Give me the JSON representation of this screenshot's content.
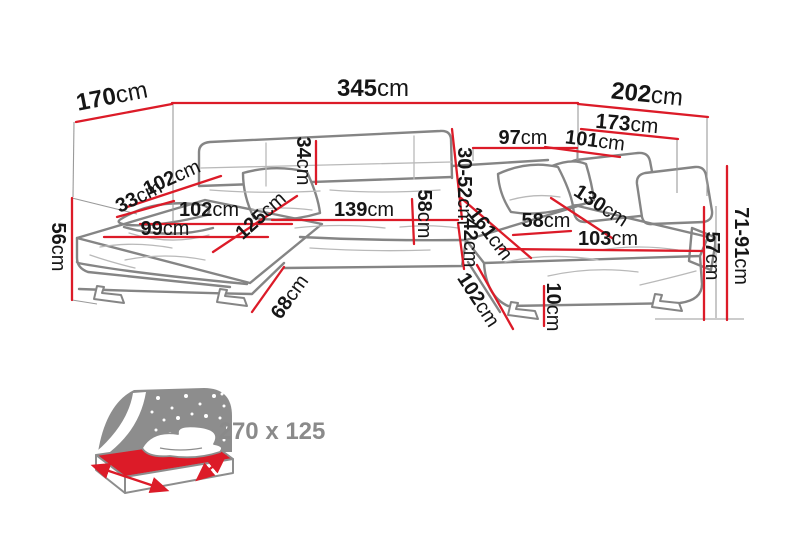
{
  "diagram": {
    "subject": "u-shaped-corner-sofa-dimensions",
    "unit_default": "cm"
  },
  "dimensions": [
    {
      "name": "back-width-left",
      "value": "170",
      "unit": "cm"
    },
    {
      "name": "total-width",
      "value": "345",
      "unit": "cm"
    },
    {
      "name": "back-width-right",
      "value": "202",
      "unit": "cm"
    },
    {
      "name": "right-side-length",
      "value": "173",
      "unit": "cm"
    },
    {
      "name": "right-back-section",
      "value": "97",
      "unit": "cm"
    },
    {
      "name": "right-inner-length",
      "value": "101",
      "unit": "cm"
    },
    {
      "name": "headrest-height",
      "value": "30-52",
      "unit": "cm"
    },
    {
      "name": "backrest-height",
      "value": "34",
      "unit": "cm"
    },
    {
      "name": "armrest-length",
      "value": "102",
      "unit": "cm"
    },
    {
      "name": "armrest-width",
      "value": "33",
      "unit": "cm"
    },
    {
      "name": "seat-depth-left",
      "value": "102",
      "unit": "cm"
    },
    {
      "name": "chaise-left-width",
      "value": "99",
      "unit": "cm"
    },
    {
      "name": "chaise-left-length",
      "value": "125",
      "unit": "cm"
    },
    {
      "name": "center-seat-width",
      "value": "139",
      "unit": "cm"
    },
    {
      "name": "seat-depth-center",
      "value": "58",
      "unit": "cm"
    },
    {
      "name": "seat-front-height",
      "value": "42",
      "unit": "cm"
    },
    {
      "name": "chaise-right-length",
      "value": "161",
      "unit": "cm"
    },
    {
      "name": "seat-depth-right",
      "value": "58",
      "unit": "cm"
    },
    {
      "name": "chaise-right-diagonal",
      "value": "130",
      "unit": "cm"
    },
    {
      "name": "chaise-right-width",
      "value": "103",
      "unit": "cm"
    },
    {
      "name": "seat-height-left",
      "value": "56",
      "unit": "cm"
    },
    {
      "name": "back-height-right",
      "value": "71-91",
      "unit": "cm"
    },
    {
      "name": "armrest-height-right",
      "value": "57",
      "unit": "cm"
    },
    {
      "name": "base-depth-left",
      "value": "68",
      "unit": "cm"
    },
    {
      "name": "base-depth-right",
      "value": "102",
      "unit": "cm"
    },
    {
      "name": "foot-height",
      "value": "10",
      "unit": "cm"
    }
  ],
  "sleeping_area": {
    "label": "270 x 125"
  },
  "colors": {
    "dimension_line": "#dc1b28",
    "sofa_outline": "#858585",
    "sofa_detail": "#b9b9b9",
    "icon_gray": "#8d8d8d",
    "label_text": "#161616"
  }
}
